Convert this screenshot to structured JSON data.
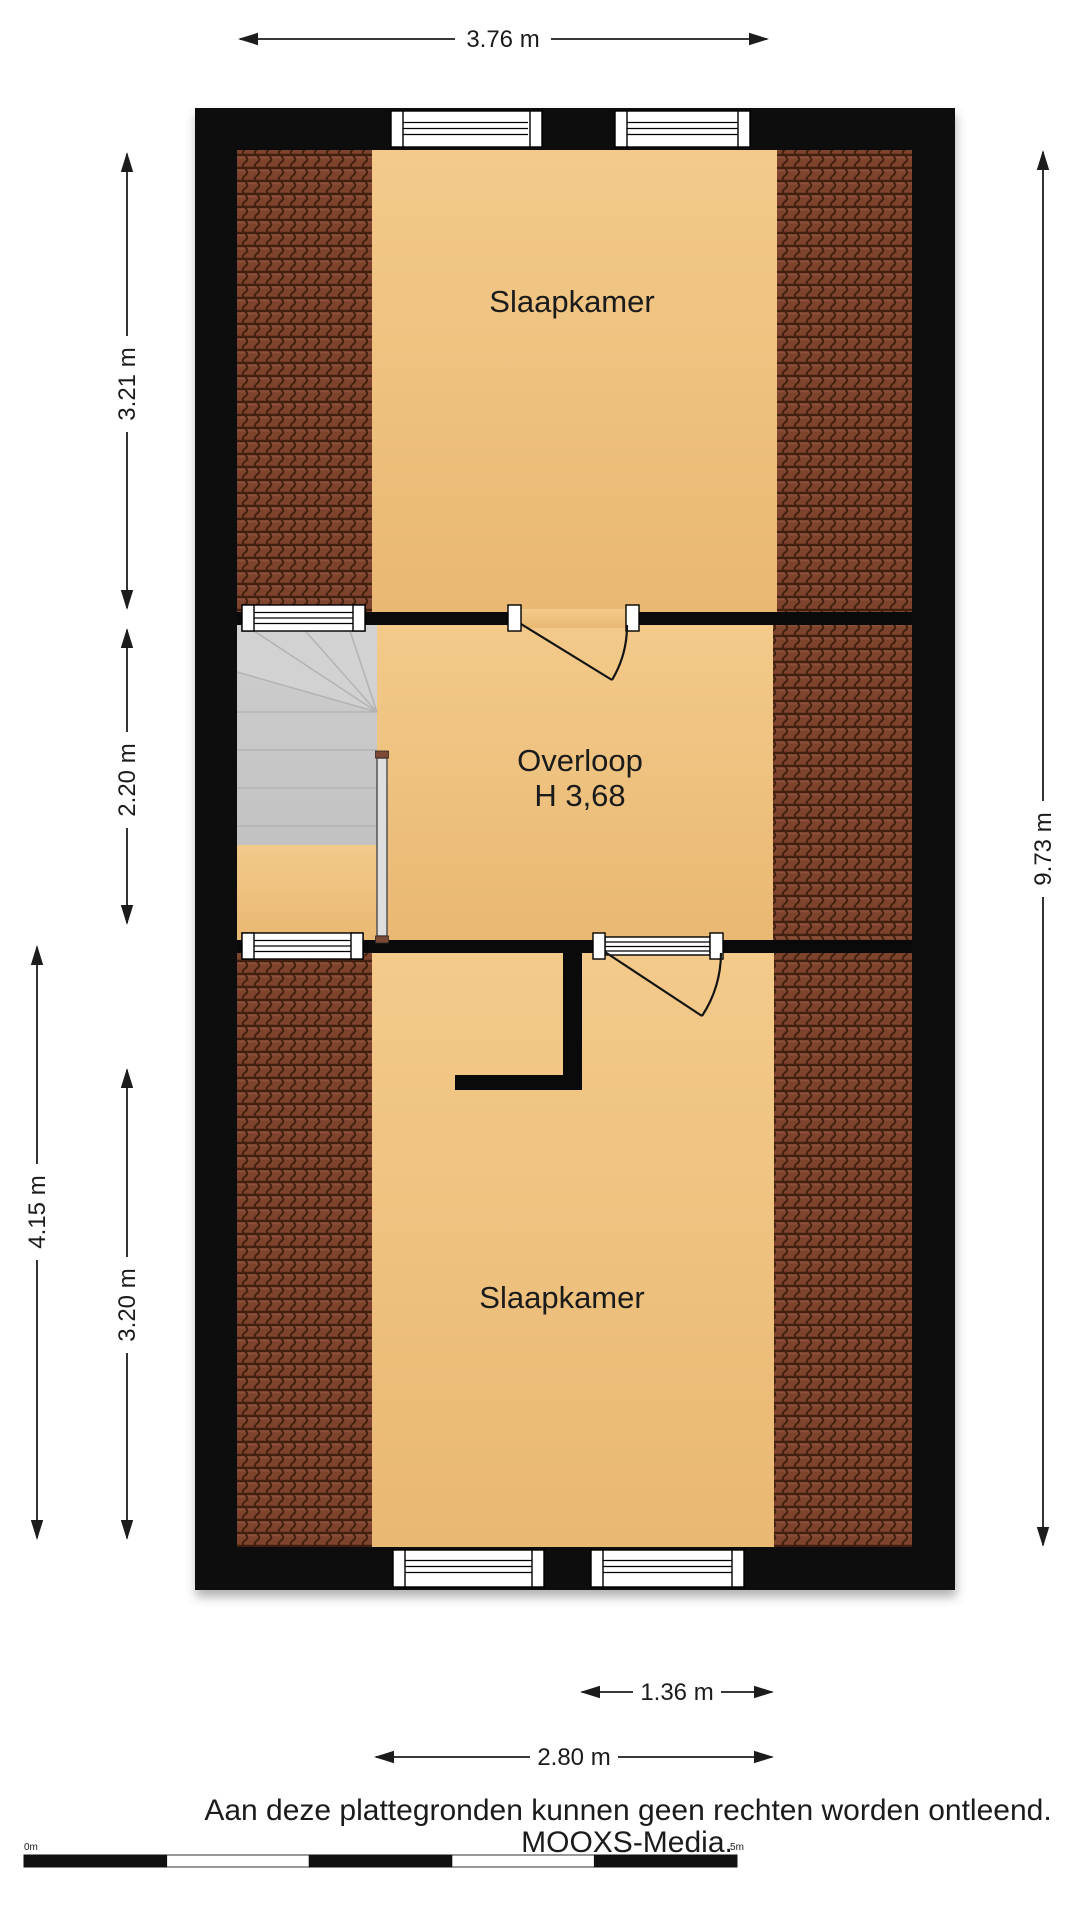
{
  "plan": {
    "rooms": {
      "bedroom_top": "Slaapkamer",
      "landing": "Overloop",
      "landing_height": "H 3,68",
      "bedroom_bottom": "Slaapkamer"
    },
    "dimensions": {
      "top_width": "3.76 m",
      "left_upper": "3.21 m",
      "left_middle": "2.20 m",
      "left_outer": "4.15 m",
      "left_lower": "3.20 m",
      "right_height": "9.73 m",
      "bottom_door": "1.36 m",
      "bottom_room": "2.80 m"
    }
  },
  "footer": {
    "disclaimer": "Aan deze plattegronden kunnen geen rechten worden ontleend.",
    "brand": "MOOXS-Media."
  },
  "scale_bar": {
    "start_label": "0m",
    "end_label": "5m"
  },
  "colors": {
    "wall": "#0a0a0a",
    "floor": "#eec07d",
    "floor-light": "#f3ca8a",
    "tile": "#7d432c",
    "tile-dark": "#41200f",
    "stairs": "#c9c9c9",
    "banister": "#dedede",
    "wood-cap": "#7b4a36",
    "dim": "#1c1c1c"
  }
}
